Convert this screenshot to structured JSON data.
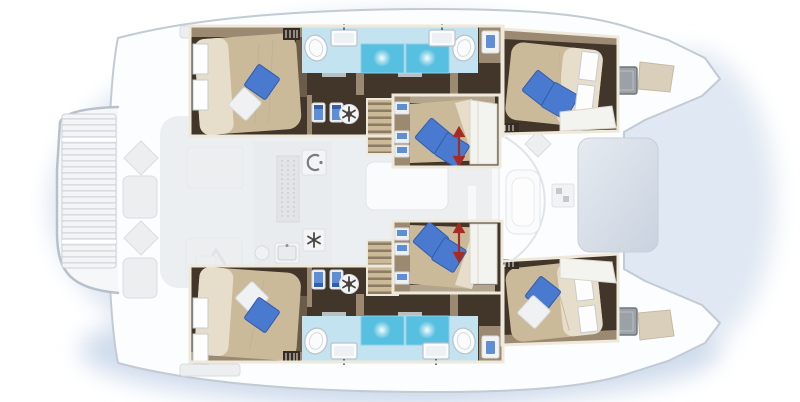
{
  "figure": {
    "type": "catamaran-deck-and-cabin-floor-plan",
    "view": "top-down",
    "orientation": "bow-right",
    "levels_shown": "deck (faded gray) and hull accommodation (full color)"
  },
  "palette": {
    "page_bg": "#ffffff",
    "water_glow": "#d7e1ef",
    "hull_white": "#fcfdfe",
    "hull_outline": "#c2cad3",
    "furniture_faded": "#eceef0",
    "furniture_outline": "#d9dde1",
    "saloon_tint": "#e7e9ec",
    "frame_cream": "#efe9db",
    "floor_dark": "#42362b",
    "wall_taupe": "#9b8a71",
    "wall_taupe_light": "#b3a58c",
    "bed_tan": "#cbba9a",
    "duvet_cream": "#e6decb",
    "pillow_blue": "#4a7ad0",
    "pillow_blue_dark": "#2f5cab",
    "pillow_white": "#f0f1f3",
    "bath_blue": "#c3e3f0",
    "shower_blue": "#57bfe0",
    "fixture_white": "#fafbfc",
    "fixture_outline": "#b9c2c8",
    "seat_blue": "#5e8ed6",
    "stair_light": "#cbb998",
    "stair_dark": "#8d7c64",
    "arrow_red": "#a62b25",
    "hatch_gray": "#9aa1a7",
    "hatch_gray_dark": "#6f767c",
    "sunpad_tan": "#d9cfba",
    "trampoline_blue": "#d3dbe6",
    "vent_dark": "#352c23"
  },
  "spaces": [
    "swim-platform-stern",
    "aft-cockpit",
    "saloon-galley",
    "aft-cabin-port",
    "bathroom-port",
    "forward-cabin-port",
    "mid-cabin-port",
    "mid-cabin-starboard",
    "aft-cabin-starboard",
    "bathroom-starboard",
    "forward-cabin-starboard",
    "forward-cockpit",
    "trampoline",
    "bow-port",
    "bow-starboard"
  ],
  "features": {
    "double_beds": 6,
    "blue_pillows": 9,
    "white_pillows": 3,
    "showers": 4,
    "toilets": 4,
    "bathroom_sinks": 4,
    "companionway_stairs": 2,
    "sliding_bed_arrows": 2,
    "deck_hatches": 2
  },
  "icons": [
    "toilet-icon",
    "sink-icon",
    "shower-icon",
    "fan-icon",
    "snowflake-icon",
    "stove-icon",
    "seat-icon",
    "stairs",
    "vent-grille-icon",
    "deck-hatch-icon",
    "slide-arrow-icon",
    "drawer-icon",
    "window",
    "pillow",
    "dish-rack-icon",
    "companionway-arrow-icon"
  ]
}
